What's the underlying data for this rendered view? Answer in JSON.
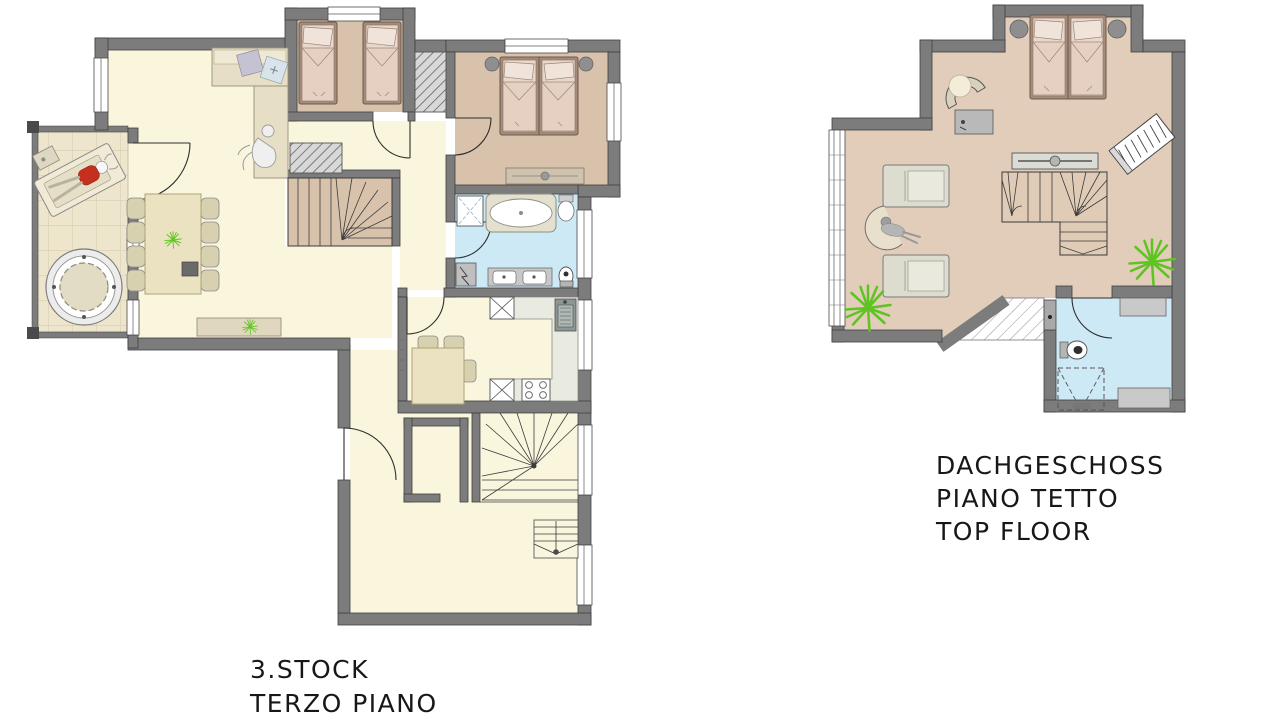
{
  "plans": {
    "third_floor": {
      "lines": [
        "3.STOCK",
        "TERZO PIANO"
      ]
    },
    "top_floor": {
      "lines": [
        "DACHGESCHOSS",
        "PIANO TETTO",
        "TOP FLOOR"
      ]
    }
  },
  "colors": {
    "wall": "#7C7C7C",
    "wallEdge": "#3F3F3F",
    "cream": "#FAF6DE",
    "tan": "#D8C2AC",
    "topFloor": "#E2CDBA",
    "blue": "#CEE9F6",
    "balcony": "#EDE5CC",
    "counter": "#E9EAE0",
    "bedframe": "#A58B7B",
    "bedfill": "#E9D7CA",
    "pillow": "#EFE3DA",
    "blanket": "#E5D0C2",
    "table": "#EBE2C2",
    "tableEdge": "#ACA377",
    "chair": "#D8D1B0",
    "grayFurn": "#C9C9C9",
    "plant": "#5FC422",
    "text": "#171717"
  }
}
